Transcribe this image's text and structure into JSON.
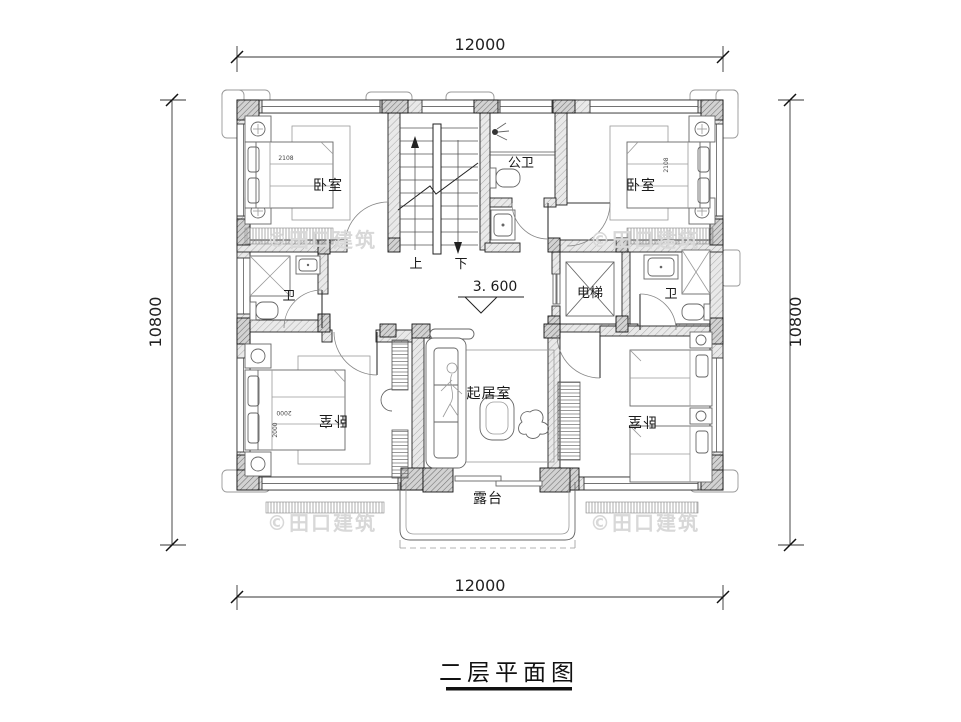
{
  "title": {
    "text": "二层平面图"
  },
  "dimensions": {
    "top": "12000",
    "bottom": "12000",
    "left": "10800",
    "right": "10800"
  },
  "elevation_marker": {
    "value": "3. 600"
  },
  "rooms": {
    "bedroom_top_left": "卧室",
    "bedroom_top_right": "卧室",
    "public_bathroom": "公卫",
    "bathroom_left": "卫",
    "bathroom_right": "卫",
    "elevator": "电梯",
    "living_room": "起居室",
    "bedroom_bottom_left": "卧室",
    "bedroom_bottom_right": "卧室",
    "terrace": "露台"
  },
  "stairs": {
    "up_label": "上",
    "down_label": "下"
  },
  "furniture_dims": {
    "bed_tl": "2108",
    "bed_tr": "2108",
    "bed_bl_w": "2000",
    "bed_bl_l": "2000"
  },
  "watermark": {
    "text": "©田口建筑"
  },
  "colors": {
    "line": "#1a1a1a",
    "wall_fill": "#e9e9e9",
    "column_fill": "#d2d2d2",
    "watermark": "#d8d8d8",
    "background": "#ffffff"
  }
}
